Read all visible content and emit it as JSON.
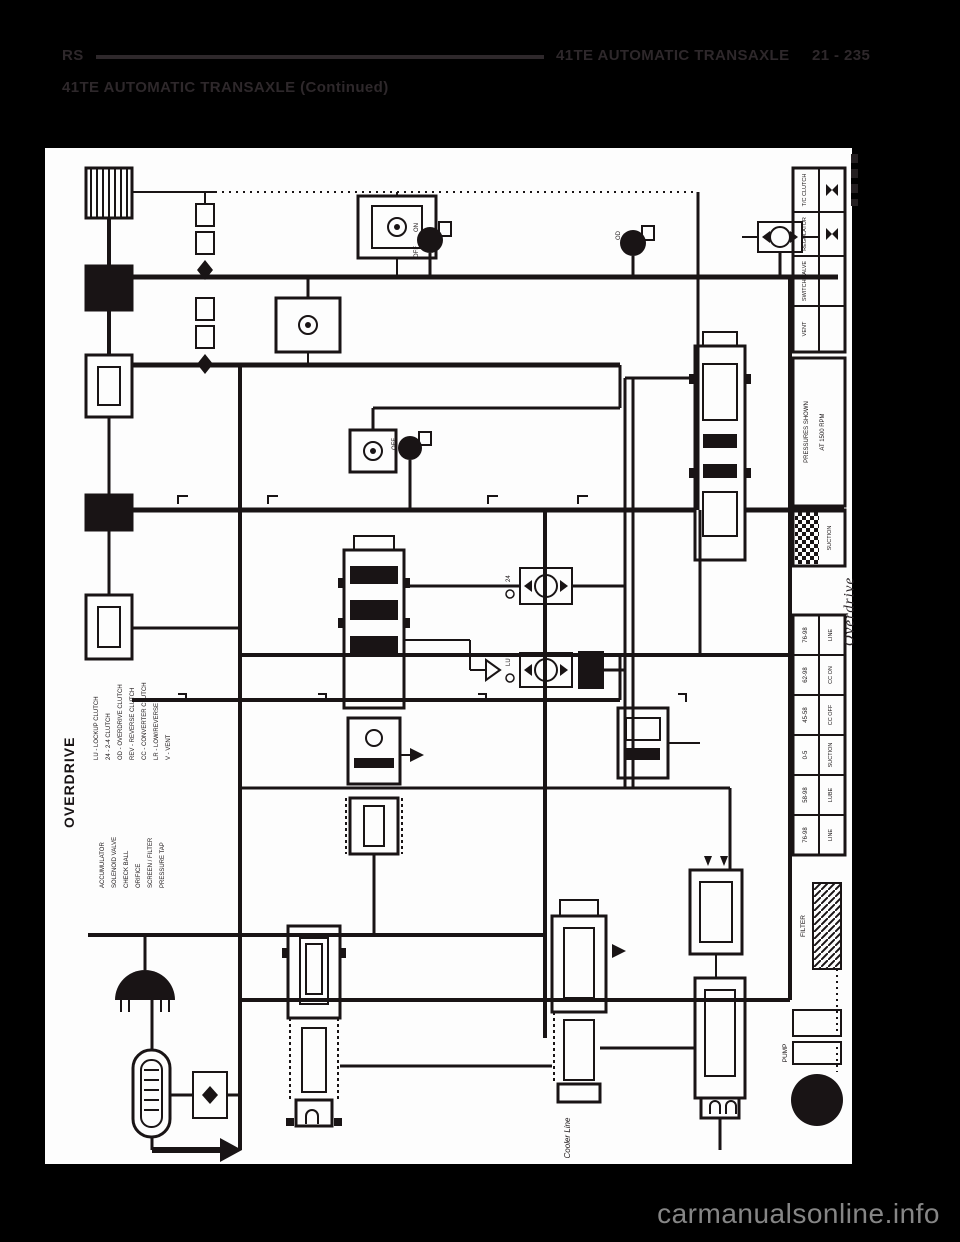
{
  "colors": {
    "page_background": "#000000",
    "paper": "#fdfdfd",
    "ink": "#191415",
    "header_ink": "#2e282b",
    "watermark_gray": "#868686"
  },
  "header": {
    "code": "RS",
    "title": "41TE AUTOMATIC TRANSAXLE",
    "page_number": "21 - 235",
    "subtitle": "41TE AUTOMATIC TRANSAXLE (Continued)"
  },
  "watermark": {
    "text": "carmanualsonline.info"
  },
  "diagram": {
    "section_label": "OVERDRIVE",
    "edge_label": "Overdrive",
    "cooler_line_label": "Cooler Line",
    "filter_label": "FILTER",
    "pump_label": "PUMP",
    "suction_label": "SUCTION",
    "note_line1": "PRESSURES SHOWN",
    "note_line2": "AT 1500 RPM",
    "solenoid_labels": {
      "on": "ON",
      "off": "OFF",
      "od": "OD",
      "lu": "LU",
      "two_four": "24"
    },
    "legend_group_1": [
      "LU - LOCKUP CLUTCH",
      "24 - 2-4 CLUTCH",
      "OD - OVERDRIVE CLUTCH",
      "REV - REVERSE CLUTCH",
      "CC - CONVERTER CLUTCH",
      "LR - LOW/REVERSE",
      "V - VENT"
    ],
    "legend_group_2": [
      "ACCUMULATOR",
      "SOLENOID VALVE",
      "CHECK BALL",
      "ORIFICE",
      "SCREEN / FILTER",
      "PRESSURE TAP"
    ],
    "right_top_table": [
      "T/C CLUTCH",
      "REGULATOR",
      "SWITCH VALVE",
      "VENT"
    ],
    "pressure_table": {
      "rows": [
        {
          "value": "76-98",
          "label": "LINE"
        },
        {
          "value": "62-98",
          "label": "CC ON"
        },
        {
          "value": "45-58",
          "label": "CC OFF"
        },
        {
          "value": "0-5",
          "label": "SUCTION"
        },
        {
          "value": "58-98",
          "label": "LUBE"
        },
        {
          "value": "76-98",
          "label": "LINE"
        }
      ]
    }
  }
}
